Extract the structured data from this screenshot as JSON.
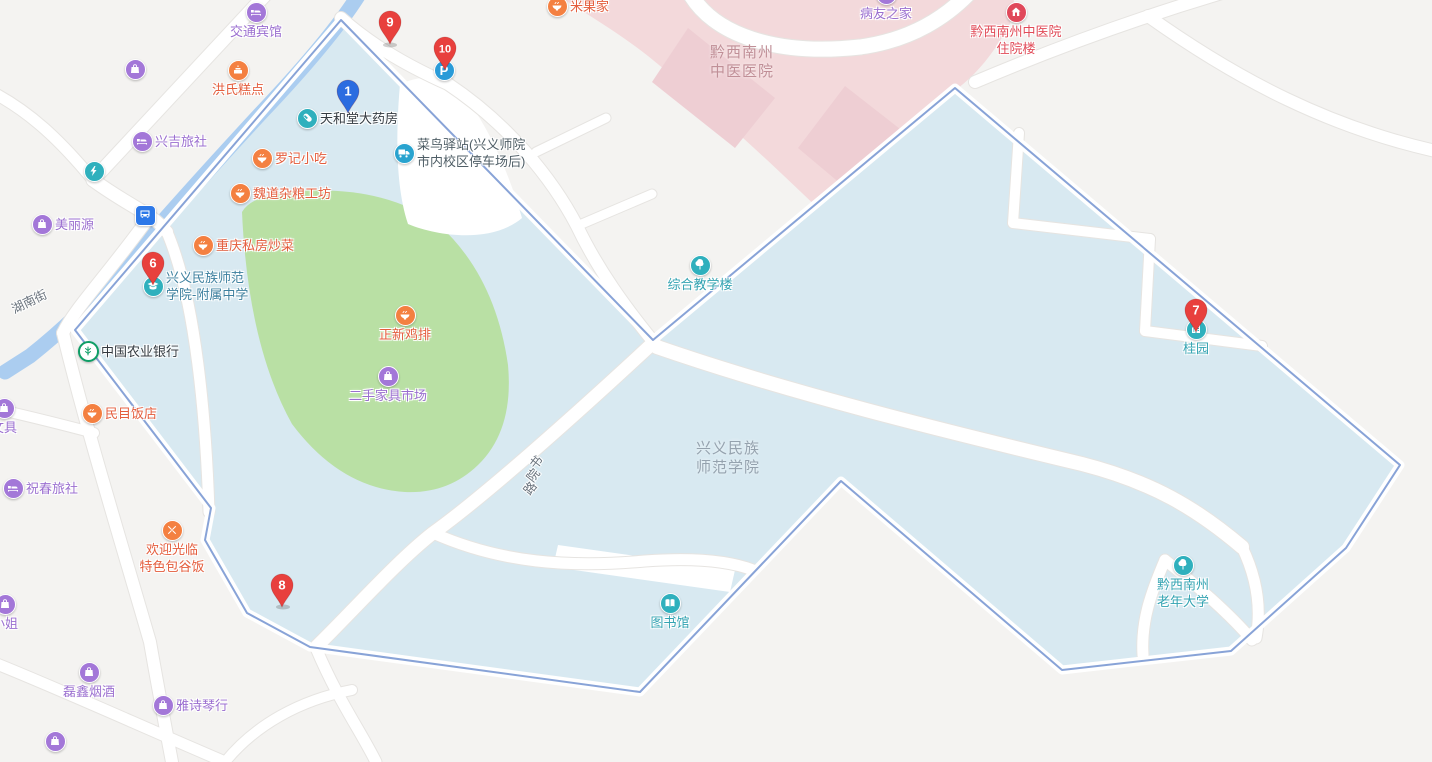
{
  "map": {
    "colors": {
      "land": "#f4f3f1",
      "campus": "#d8e9f1",
      "campus_border": "#7b99d3",
      "green": "#b9e0a4",
      "hospital": "#f3d9db",
      "hospital_dark": "#eeced3",
      "river": "#abcdf0",
      "road": "#ffffff",
      "purple": "#a377d8",
      "purple_text": "#9b6fd0",
      "orange": "#f48041",
      "orange_text": "#e45d3d",
      "teal": "#2fb0bd",
      "teal_text": "#33a3b2",
      "blue": "#2d78e8",
      "parking_blue": "#2a9bd8",
      "cainiao": "#29a3cf",
      "red_icon": "#e0485a",
      "pin_red": "#e8403d",
      "pin_blue": "#2b6ce0",
      "dark_text": "#333a40",
      "slate_text": "#4f5e66",
      "school_text": "#3c7f9e",
      "hospital_text": "#c08f97",
      "red_text": "#e14b58",
      "campus_text": "#95a2ae",
      "street_text": "#6a737d",
      "bank_green": "#0e9e66"
    },
    "pins": [
      {
        "number": "9",
        "x": 390,
        "y": 22,
        "color": "pin_red"
      },
      {
        "number": "10",
        "x": 445,
        "y": 48,
        "color": "pin_red"
      },
      {
        "number": "1",
        "x": 348,
        "y": 91,
        "color": "pin_blue"
      },
      {
        "number": "6",
        "x": 153,
        "y": 263,
        "color": "pin_red"
      },
      {
        "number": "7",
        "x": 1196,
        "y": 310,
        "color": "pin_red"
      },
      {
        "number": "8",
        "x": 282,
        "y": 585,
        "color": "pin_red"
      }
    ],
    "pois": [
      {
        "id": "jiaotong-binguan",
        "lines": [
          "交通宾馆"
        ],
        "icon": "hotel",
        "ic": "purple",
        "tc": "purple_text",
        "x": 256,
        "y": 12,
        "layout": "below"
      },
      {
        "id": "yancao-gongsi",
        "lines": [
          "黔西南州烟草",
          "公司兴义市"
        ],
        "icon": "bag",
        "ic": "purple",
        "tc": "purple_text",
        "x": 135,
        "y": 69,
        "layout": "left"
      },
      {
        "id": "hongshi-gaodian",
        "lines": [
          "洪氏糕点"
        ],
        "icon": "cake",
        "ic": "orange",
        "tc": "orange_text",
        "x": 238,
        "y": 70,
        "layout": "below"
      },
      {
        "id": "xingji-lvshe",
        "lines": [
          "兴吉旅社"
        ],
        "icon": "hotel",
        "ic": "purple",
        "tc": "purple_text",
        "x": 142,
        "y": 141,
        "layout": "right"
      },
      {
        "id": "xingyi-gongdianju",
        "lines": [
          "兴义供电局"
        ],
        "icon": "bolt",
        "ic": "teal",
        "tc": "purple_text",
        "x": 94,
        "y": 171,
        "layout": "left"
      },
      {
        "id": "meiliyuan",
        "lines": [
          "美丽源"
        ],
        "icon": "bag",
        "ic": "purple",
        "tc": "purple_text",
        "x": 42,
        "y": 224,
        "layout": "right"
      },
      {
        "id": "bus-station",
        "lines": [],
        "icon": "bus",
        "ic": "blue",
        "tc": "dark_text",
        "x": 145,
        "y": 215,
        "layout": "icon"
      },
      {
        "id": "tianhetang-dayaofang",
        "lines": [
          "天和堂大药房"
        ],
        "icon": "pill",
        "ic": "teal",
        "tc": "dark_text",
        "x": 307,
        "y": 118,
        "layout": "right"
      },
      {
        "id": "luoji-xiaochi",
        "lines": [
          "罗记小吃"
        ],
        "icon": "bowl",
        "ic": "orange",
        "tc": "orange_text",
        "x": 262,
        "y": 158,
        "layout": "right"
      },
      {
        "id": "weidao-zaliang-gongfang",
        "lines": [
          "魏道杂粮工坊"
        ],
        "icon": "bowl",
        "ic": "orange",
        "tc": "orange_text",
        "x": 240,
        "y": 193,
        "layout": "right"
      },
      {
        "id": "chongqing-sifang-chaocai",
        "lines": [
          "重庆私房炒菜"
        ],
        "icon": "bowl",
        "ic": "orange",
        "tc": "orange_text",
        "x": 203,
        "y": 245,
        "layout": "right"
      },
      {
        "id": "fushu-zhongxue",
        "lines": [
          "兴义民族师范",
          "学院-附属中学"
        ],
        "icon": "cap",
        "ic": "teal",
        "tc": "school_text",
        "x": 153,
        "y": 286,
        "layout": "right"
      },
      {
        "id": "zhongguo-nongye-yinhang",
        "lines": [
          "中国农业银行"
        ],
        "icon": "bank",
        "ic": "bank_green",
        "tc": "dark_text",
        "x": 88,
        "y": 351,
        "layout": "right"
      },
      {
        "id": "minmu-fandian",
        "lines": [
          "民目饭店"
        ],
        "icon": "bowl",
        "ic": "orange",
        "tc": "orange_text",
        "x": 92,
        "y": 413,
        "layout": "right"
      },
      {
        "id": "wenju",
        "lines": [
          "文具"
        ],
        "icon": "bag",
        "ic": "purple",
        "tc": "purple_text",
        "x": 4,
        "y": 408,
        "layout": "below"
      },
      {
        "id": "zhuchun-lvshe",
        "lines": [
          "祝春旅社"
        ],
        "icon": "hotel",
        "ic": "purple",
        "tc": "purple_text",
        "x": 13,
        "y": 488,
        "layout": "right"
      },
      {
        "id": "zhengxin-jipai",
        "lines": [
          "正新鸡排"
        ],
        "icon": "bowl",
        "ic": "orange",
        "tc": "orange_text",
        "x": 405,
        "y": 315,
        "layout": "below"
      },
      {
        "id": "ershou-jiaju-shichang",
        "lines": [
          "二手家具市场"
        ],
        "icon": "bag",
        "ic": "purple",
        "tc": "purple_text",
        "x": 388,
        "y": 376,
        "layout": "below"
      },
      {
        "id": "huanying-guanglin",
        "lines": [
          "欢迎光临",
          "特色包谷饭"
        ],
        "icon": "xfork",
        "ic": "orange",
        "tc": "orange_text",
        "x": 172,
        "y": 530,
        "layout": "below"
      },
      {
        "id": "xiaojie",
        "lines": [
          "小姐"
        ],
        "icon": "bag",
        "ic": "purple",
        "tc": "purple_text",
        "x": 5,
        "y": 604,
        "layout": "below"
      },
      {
        "id": "leixin-yanjiu",
        "lines": [
          "磊鑫烟酒"
        ],
        "icon": "bag",
        "ic": "purple",
        "tc": "purple_text",
        "x": 89,
        "y": 672,
        "layout": "below"
      },
      {
        "id": "yashi-qinhang",
        "lines": [
          "雅诗琴行"
        ],
        "icon": "bag",
        "ic": "purple",
        "tc": "purple_text",
        "x": 163,
        "y": 705,
        "layout": "right"
      },
      {
        "id": "yueliang-zhiyi",
        "lines": [
          "月亮制衣"
        ],
        "icon": "bag",
        "ic": "purple",
        "tc": "purple_text",
        "x": 55,
        "y": 741,
        "layout": "left"
      },
      {
        "id": "cainiao-yizhan",
        "lines": [
          "菜鸟驿站(兴义师院",
          "市内校区停车场后)"
        ],
        "icon": "truck",
        "ic": "cainiao",
        "tc": "slate_text",
        "x": 404,
        "y": 153,
        "layout": "right"
      },
      {
        "id": "parking",
        "lines": [],
        "icon": "parking",
        "ic": "parking_blue",
        "tc": "dark_text",
        "x": 444,
        "y": 70,
        "layout": "icon"
      },
      {
        "id": "miguo-jia",
        "lines": [
          "米果家"
        ],
        "icon": "bowl",
        "ic": "orange",
        "tc": "orange_text",
        "x": 557,
        "y": 6,
        "layout": "right"
      },
      {
        "id": "bingyou-zhijia",
        "lines": [
          "病友之家"
        ],
        "icon": "house",
        "ic": "purple",
        "tc": "purple_text",
        "x": 886,
        "y": -6,
        "layout": "below"
      },
      {
        "id": "zhuyuanlou",
        "lines": [
          "黔西南州中医院",
          "住院楼"
        ],
        "icon": "house",
        "ic": "red_icon",
        "tc": "red_text",
        "x": 1016,
        "y": 12,
        "layout": "below"
      },
      {
        "id": "zonghe-jiaoxuelou",
        "lines": [
          "综合教学楼"
        ],
        "icon": "tree",
        "ic": "teal",
        "tc": "teal_text",
        "x": 700,
        "y": 265,
        "layout": "below"
      },
      {
        "id": "guiyuan",
        "lines": [
          "桂园"
        ],
        "icon": "building",
        "ic": "teal",
        "tc": "teal_text",
        "x": 1196,
        "y": 329,
        "layout": "below"
      },
      {
        "id": "tushuguan",
        "lines": [
          "图书馆"
        ],
        "icon": "book",
        "ic": "teal",
        "tc": "teal_text",
        "x": 670,
        "y": 603,
        "layout": "below"
      },
      {
        "id": "laonian-daxue",
        "lines": [
          "黔西南州",
          "老年大学"
        ],
        "icon": "tree",
        "ic": "teal",
        "tc": "teal_text",
        "x": 1183,
        "y": 565,
        "layout": "below"
      }
    ],
    "area_labels": [
      {
        "id": "zhongyi-yiyuan",
        "lines": [
          "黔西南州",
          "中医医院"
        ],
        "x": 742,
        "y": 62,
        "color": "hospital_text"
      },
      {
        "id": "shifan-xueyuan",
        "lines": [
          "兴义民族",
          "师范学院"
        ],
        "x": 728,
        "y": 458,
        "color": "campus_text"
      }
    ],
    "street_labels": [
      {
        "id": "hunan-jie",
        "text": "湖南街",
        "x": 32,
        "y": 299,
        "rot": -26,
        "vertical": false
      },
      {
        "id": "shuyuan-lu",
        "text": "书院路",
        "x": 533,
        "y": 472,
        "rot": -52,
        "vertical": true
      }
    ]
  }
}
